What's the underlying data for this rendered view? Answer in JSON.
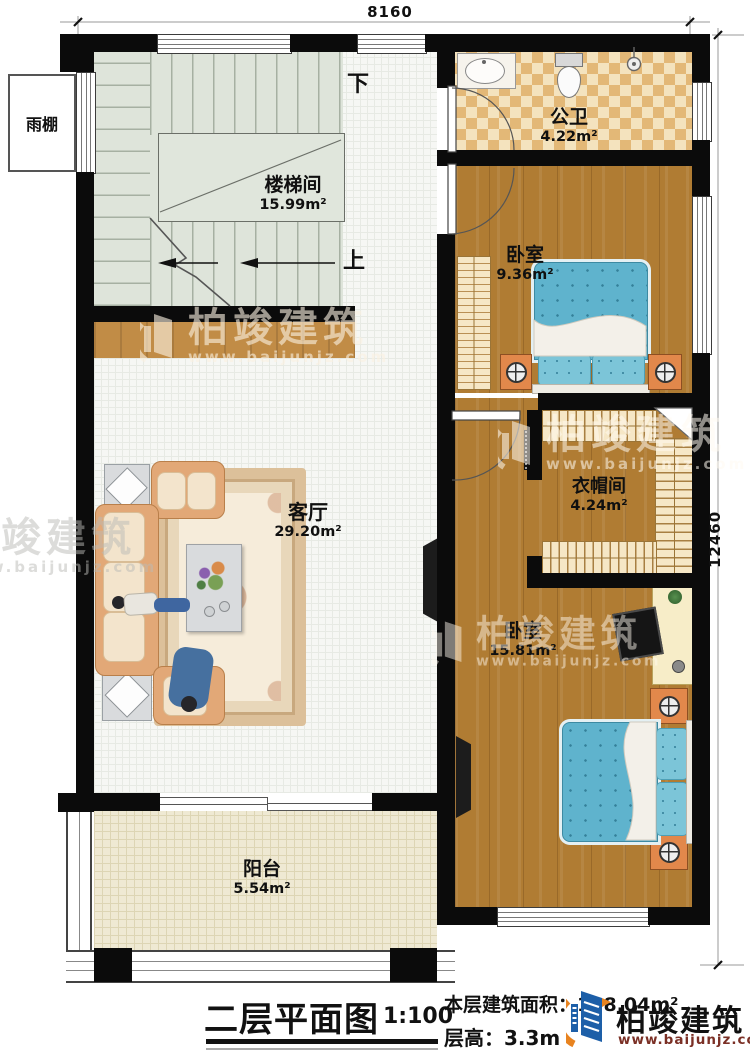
{
  "plan": {
    "dim_top": "8160",
    "dim_right": "12460",
    "canopy": {
      "name": "雨棚"
    },
    "stairwell": {
      "name": "楼梯间",
      "area": "15.99m²",
      "down": "下",
      "up": "上"
    },
    "bathroom": {
      "name": "公卫",
      "area": "4.22m²"
    },
    "bedroom_top": {
      "name": "卧室",
      "area": "9.36m²"
    },
    "cloakroom": {
      "name": "衣帽间",
      "area": "4.24m²"
    },
    "bedroom_main": {
      "name": "卧室",
      "area": "15.81m²"
    },
    "living": {
      "name": "客厅",
      "area": "29.20m²"
    },
    "balcony": {
      "name": "阳台",
      "area": "5.54m²"
    }
  },
  "title": {
    "name": "二层平面图",
    "scale": "1:100",
    "floor_area": "本层建筑面积：128.04m²",
    "floor_height": "层高：3.3m"
  },
  "brand": {
    "name": "柏竣建筑",
    "url": "www.baijunjz.com"
  },
  "watermark": {
    "name": "柏竣建筑",
    "url": "www.baijunjz.com"
  },
  "colors": {
    "wall": "#0b0b0b",
    "wood": "#b07c33",
    "bed_blue": "#5fb3cd",
    "brand_blue": "#1d5fa8",
    "brand_orange": "#e8831f",
    "url_red": "#7b3026"
  }
}
